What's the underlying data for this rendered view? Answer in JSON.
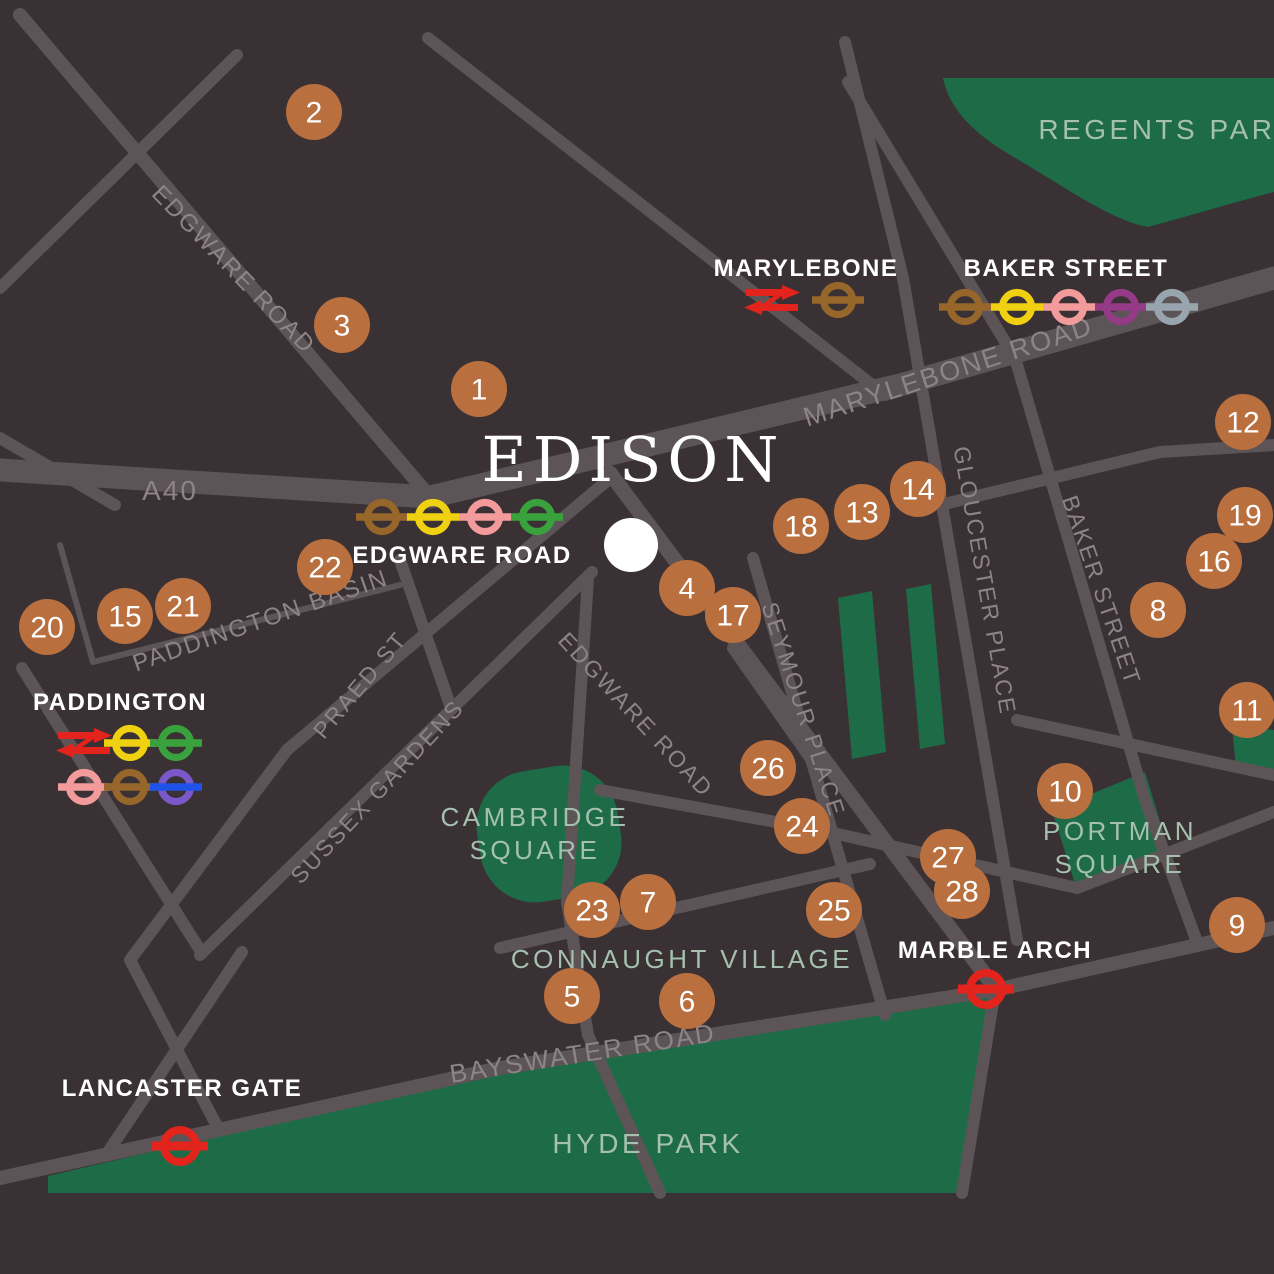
{
  "colors": {
    "background": "#3a3135",
    "road": "#5c5456",
    "road_label": "#8d8487",
    "park": "#1e6b48",
    "park_label": "#a5c0af",
    "marker": "#b96f3e",
    "marker_text": "#ffffff",
    "station_label": "#ffffff",
    "site_circle": "#ffffff",
    "lines": {
      "bakerloo": "#96662b",
      "circle": "#f0d111",
      "hammersmith-city": "#f39b9b",
      "district": "#3aa23d",
      "metropolitan": "#953a87",
      "jubilee": "#98a5af",
      "central": "#e3241d",
      "elizabeth-ring": "#7a58c9",
      "elizabeth-bar": "#1f53e8",
      "national-rail": "#e3241d"
    }
  },
  "site": {
    "title": "EDISON",
    "title_x": 633,
    "title_y": 481,
    "x": 631,
    "y": 545,
    "r": 27
  },
  "markers": [
    {
      "n": "1",
      "x": 479,
      "y": 389
    },
    {
      "n": "2",
      "x": 314,
      "y": 112
    },
    {
      "n": "3",
      "x": 342,
      "y": 325
    },
    {
      "n": "4",
      "x": 687,
      "y": 588
    },
    {
      "n": "5",
      "x": 572,
      "y": 996
    },
    {
      "n": "6",
      "x": 687,
      "y": 1001
    },
    {
      "n": "7",
      "x": 648,
      "y": 902
    },
    {
      "n": "8",
      "x": 1158,
      "y": 610
    },
    {
      "n": "9",
      "x": 1237,
      "y": 925
    },
    {
      "n": "10",
      "x": 1065,
      "y": 791
    },
    {
      "n": "11",
      "x": 1247,
      "y": 710
    },
    {
      "n": "12",
      "x": 1243,
      "y": 422
    },
    {
      "n": "13",
      "x": 862,
      "y": 512
    },
    {
      "n": "14",
      "x": 918,
      "y": 489
    },
    {
      "n": "15",
      "x": 125,
      "y": 616
    },
    {
      "n": "16",
      "x": 1214,
      "y": 561
    },
    {
      "n": "17",
      "x": 733,
      "y": 615
    },
    {
      "n": "18",
      "x": 801,
      "y": 526
    },
    {
      "n": "19",
      "x": 1245,
      "y": 515
    },
    {
      "n": "20",
      "x": 47,
      "y": 627
    },
    {
      "n": "21",
      "x": 183,
      "y": 606
    },
    {
      "n": "22",
      "x": 325,
      "y": 567
    },
    {
      "n": "23",
      "x": 592,
      "y": 910
    },
    {
      "n": "24",
      "x": 802,
      "y": 826
    },
    {
      "n": "25",
      "x": 834,
      "y": 910
    },
    {
      "n": "26",
      "x": 768,
      "y": 768
    },
    {
      "n": "27",
      "x": 948,
      "y": 857
    },
    {
      "n": "28",
      "x": 962,
      "y": 891
    }
  ],
  "stations": [
    {
      "id": "marylebone",
      "name": "MARYLEBONE",
      "label": {
        "x": 806,
        "y": 276
      },
      "symbols": [
        {
          "type": "national-rail",
          "x": 772,
          "y": 300
        },
        {
          "line": "bakerloo",
          "x": 838,
          "y": 300
        }
      ]
    },
    {
      "id": "baker-street",
      "name": "BAKER STREET",
      "label": {
        "x": 1066,
        "y": 276
      },
      "symbols": [
        {
          "line": "bakerloo",
          "x": 965,
          "y": 307
        },
        {
          "line": "circle",
          "x": 1017,
          "y": 307
        },
        {
          "line": "hammersmith-city",
          "x": 1069,
          "y": 307
        },
        {
          "line": "metropolitan",
          "x": 1121,
          "y": 307
        },
        {
          "line": "jubilee",
          "x": 1172,
          "y": 307
        }
      ]
    },
    {
      "id": "edgware-road",
      "name": "EDGWARE ROAD",
      "label": {
        "x": 462,
        "y": 563
      },
      "symbols": [
        {
          "line": "bakerloo",
          "x": 382,
          "y": 517
        },
        {
          "line": "circle",
          "x": 433,
          "y": 517
        },
        {
          "line": "hammersmith-city",
          "x": 485,
          "y": 517
        },
        {
          "line": "district",
          "x": 537,
          "y": 517
        }
      ]
    },
    {
      "id": "paddington",
      "name": "PADDINGTON",
      "label": {
        "x": 120,
        "y": 710
      },
      "symbols": [
        {
          "type": "national-rail",
          "x": 84,
          "y": 743
        },
        {
          "line": "circle",
          "x": 130,
          "y": 743
        },
        {
          "line": "district",
          "x": 176,
          "y": 743
        },
        {
          "line": "hammersmith-city",
          "x": 84,
          "y": 787
        },
        {
          "line": "bakerloo",
          "x": 130,
          "y": 787
        },
        {
          "line": "elizabeth",
          "x": 176,
          "y": 787
        }
      ]
    },
    {
      "id": "marble-arch",
      "name": "MARBLE ARCH",
      "label": {
        "x": 995,
        "y": 958
      },
      "symbols": [
        {
          "line": "central",
          "x": 986,
          "y": 989,
          "large": true
        }
      ]
    },
    {
      "id": "lancaster-gate",
      "name": "LANCASTER GATE",
      "label": {
        "x": 182,
        "y": 1096
      },
      "symbols": [
        {
          "line": "central",
          "x": 180,
          "y": 1146,
          "large": true
        }
      ]
    }
  ],
  "road_labels": [
    {
      "text": "EDGWARE ROAD",
      "x": 228,
      "y": 275,
      "rotate": 46,
      "size": 24
    },
    {
      "text": "A40",
      "x": 170,
      "y": 500,
      "rotate": 0,
      "size": 28
    },
    {
      "text": "MARYLEBONE ROAD",
      "x": 951,
      "y": 380,
      "rotate": -18,
      "size": 27
    },
    {
      "text": "PADDINGTON BASIN",
      "x": 263,
      "y": 628,
      "rotate": -19,
      "size": 24
    },
    {
      "text": "PRAED ST",
      "x": 366,
      "y": 690,
      "rotate": -50,
      "size": 23
    },
    {
      "text": "SUSSEX GARDENS",
      "x": 383,
      "y": 797,
      "rotate": -47,
      "size": 23
    },
    {
      "text": "EDGWARE ROAD",
      "x": 630,
      "y": 720,
      "rotate": 47,
      "size": 23
    },
    {
      "text": "SEYMOUR PLACE",
      "x": 796,
      "y": 712,
      "rotate": 72,
      "size": 23
    },
    {
      "text": "GLOUCESTER PLACE",
      "x": 977,
      "y": 582,
      "rotate": 80,
      "size": 23
    },
    {
      "text": "BAKER STREET",
      "x": 1094,
      "y": 593,
      "rotate": 71,
      "size": 23
    },
    {
      "text": "BAYSWATER ROAD",
      "x": 584,
      "y": 1062,
      "rotate": -9,
      "size": 26
    }
  ],
  "area_labels": [
    {
      "id": "regents-park",
      "lines": [
        "REGENTS PARK"
      ],
      "x": 1168,
      "y": 139,
      "size": 28
    },
    {
      "id": "cambridge-square",
      "lines": [
        "CAMBRIDGE",
        "SQUARE"
      ],
      "x": 535,
      "y": 826,
      "size": 26
    },
    {
      "id": "connaught-village",
      "lines": [
        "CONNAUGHT VILLAGE"
      ],
      "x": 682,
      "y": 968,
      "size": 26
    },
    {
      "id": "portman-square",
      "lines": [
        "PORTMAN",
        "SQUARE"
      ],
      "x": 1120,
      "y": 840,
      "size": 26
    },
    {
      "id": "hyde-park",
      "lines": [
        "HYDE PARK"
      ],
      "x": 648,
      "y": 1153,
      "size": 28
    }
  ]
}
